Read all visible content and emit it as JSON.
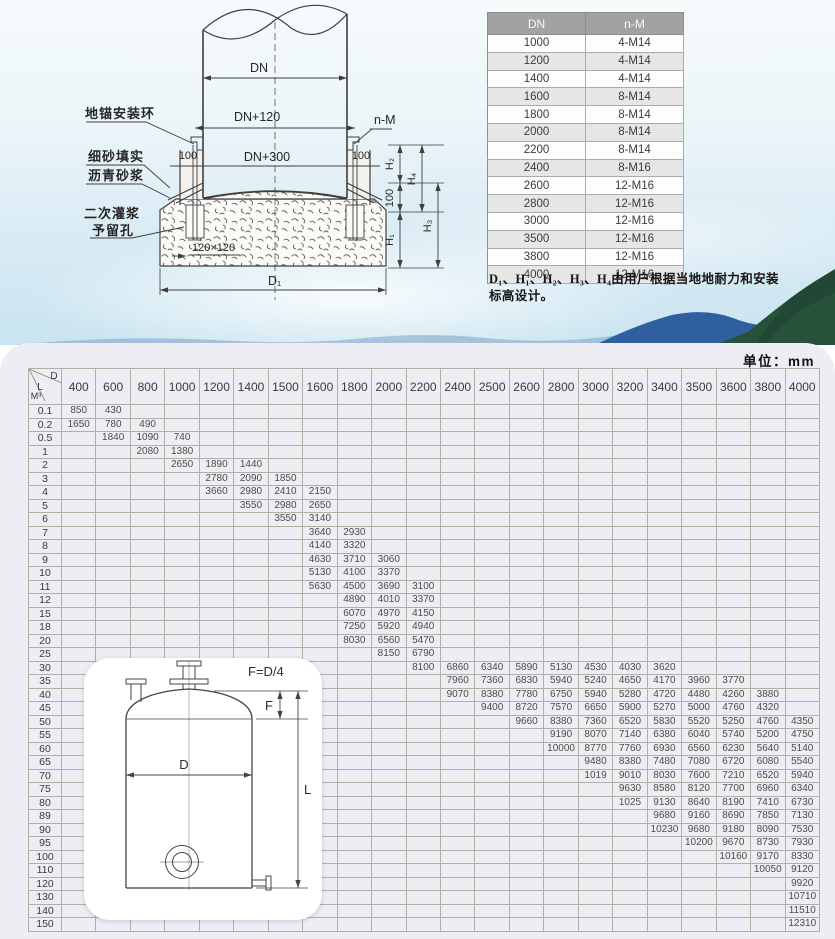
{
  "diagram": {
    "labels": {
      "anchor_ring": "地锚安装环",
      "fine_sand": "细砂填实",
      "asphalt_mortar": "沥青砂浆",
      "secondary_grout": "二次灌浆",
      "reserved_hole": "予留孔",
      "dn": "DN",
      "dn_plus_120": "DN+120",
      "dn_plus_300": "DN+300",
      "n_m": "n-M",
      "dim_100_left": "100",
      "dim_100_right": "100",
      "dim_100_vert": "100",
      "pocket": "120×120",
      "d1": "D₁",
      "h1": "H₁",
      "h2": "H₂",
      "h3": "H₃",
      "h4": "H₄"
    }
  },
  "dn_table": {
    "headers": [
      "DN",
      "n-M"
    ],
    "rows": [
      [
        "1000",
        "4-M14"
      ],
      [
        "1200",
        "4-M14"
      ],
      [
        "1400",
        "4-M14"
      ],
      [
        "1600",
        "8-M14"
      ],
      [
        "1800",
        "8-M14"
      ],
      [
        "2000",
        "8-M14"
      ],
      [
        "2200",
        "8-M14"
      ],
      [
        "2400",
        "8-M16"
      ],
      [
        "2600",
        "12-M16"
      ],
      [
        "2800",
        "12-M16"
      ],
      [
        "3000",
        "12-M16"
      ],
      [
        "3500",
        "12-M16"
      ],
      [
        "3800",
        "12-M16"
      ],
      [
        "4000",
        "12-M16"
      ]
    ]
  },
  "note": "D₁、H₁、H₂、H₃、H₄由用户根据当地地耐力和安装标高设计。",
  "capacity_table": {
    "unit_label": "单位：mm",
    "corner": {
      "d": "D",
      "l": "L",
      "m3": "M³"
    },
    "columns": [
      "400",
      "600",
      "800",
      "1000",
      "1200",
      "1400",
      "1500",
      "1600",
      "1800",
      "2000",
      "2200",
      "2400",
      "2500",
      "2600",
      "2800",
      "3000",
      "3200",
      "3400",
      "3500",
      "3600",
      "3800",
      "4000"
    ],
    "rows": [
      {
        "label": "0.1",
        "offset": 0,
        "values": [
          "850",
          "430"
        ]
      },
      {
        "label": "0.2",
        "offset": 0,
        "values": [
          "1650",
          "780",
          "490"
        ]
      },
      {
        "label": "0.5",
        "offset": 1,
        "values": [
          "1840",
          "1090",
          "740"
        ]
      },
      {
        "label": "1",
        "offset": 2,
        "values": [
          "2080",
          "1380"
        ]
      },
      {
        "label": "2",
        "offset": 3,
        "values": [
          "2650",
          "1890",
          "1440"
        ]
      },
      {
        "label": "3",
        "offset": 4,
        "values": [
          "2780",
          "2090",
          "1850"
        ]
      },
      {
        "label": "4",
        "offset": 4,
        "values": [
          "3660",
          "2980",
          "2410",
          "2150"
        ]
      },
      {
        "label": "5",
        "offset": 5,
        "values": [
          "3550",
          "2980",
          "2650"
        ]
      },
      {
        "label": "6",
        "offset": 6,
        "values": [
          "3550",
          "3140"
        ]
      },
      {
        "label": "7",
        "offset": 7,
        "values": [
          "3640",
          "2930"
        ]
      },
      {
        "label": "8",
        "offset": 7,
        "values": [
          "4140",
          "3320"
        ]
      },
      {
        "label": "9",
        "offset": 7,
        "values": [
          "4630",
          "3710",
          "3060"
        ]
      },
      {
        "label": "10",
        "offset": 7,
        "values": [
          "5130",
          "4100",
          "3370"
        ]
      },
      {
        "label": "11",
        "offset": 7,
        "values": [
          "5630",
          "4500",
          "3690",
          "3100"
        ]
      },
      {
        "label": "12",
        "offset": 8,
        "values": [
          "4890",
          "4010",
          "3370"
        ]
      },
      {
        "label": "15",
        "offset": 8,
        "values": [
          "6070",
          "4970",
          "4150"
        ]
      },
      {
        "label": "18",
        "offset": 8,
        "values": [
          "7250",
          "5920",
          "4940"
        ]
      },
      {
        "label": "20",
        "offset": 8,
        "values": [
          "8030",
          "6560",
          "5470"
        ]
      },
      {
        "label": "25",
        "offset": 9,
        "values": [
          "8150",
          "6790"
        ]
      },
      {
        "label": "30",
        "offset": 10,
        "values": [
          "8100",
          "6860",
          "6340",
          "5890",
          "5130",
          "4530",
          "4030",
          "3620"
        ]
      },
      {
        "label": "35",
        "offset": 11,
        "values": [
          "7960",
          "7360",
          "6830",
          "5940",
          "5240",
          "4650",
          "4170",
          "3960",
          "3770"
        ]
      },
      {
        "label": "40",
        "offset": 11,
        "values": [
          "9070",
          "8380",
          "7780",
          "6750",
          "5940",
          "5280",
          "4720",
          "4480",
          "4260",
          "3880"
        ]
      },
      {
        "label": "45",
        "offset": 12,
        "values": [
          "9400",
          "8720",
          "7570",
          "6650",
          "5900",
          "5270",
          "5000",
          "4760",
          "4320"
        ]
      },
      {
        "label": "50",
        "offset": 13,
        "values": [
          "9660",
          "8380",
          "7360",
          "6520",
          "5830",
          "5520",
          "5250",
          "4760",
          "4350"
        ]
      },
      {
        "label": "55",
        "offset": 14,
        "values": [
          "9190",
          "8070",
          "7140",
          "6380",
          "6040",
          "5740",
          "5200",
          "4750"
        ]
      },
      {
        "label": "60",
        "offset": 14,
        "values": [
          "10000",
          "8770",
          "7760",
          "6930",
          "6560",
          "6230",
          "5640",
          "5140"
        ]
      },
      {
        "label": "65",
        "offset": 15,
        "values": [
          "9480",
          "8380",
          "7480",
          "7080",
          "6720",
          "6080",
          "5540"
        ]
      },
      {
        "label": "70",
        "offset": 15,
        "values": [
          "1019",
          "9010",
          "8030",
          "7600",
          "7210",
          "6520",
          "5940"
        ]
      },
      {
        "label": "75",
        "offset": 16,
        "values": [
          "9630",
          "8580",
          "8120",
          "7700",
          "6960",
          "6340"
        ]
      },
      {
        "label": "80",
        "offset": 16,
        "values": [
          "1025",
          "9130",
          "8640",
          "8190",
          "7410",
          "6730"
        ]
      },
      {
        "label": "89",
        "offset": 17,
        "values": [
          "9680",
          "9160",
          "8690",
          "7850",
          "7130"
        ]
      },
      {
        "label": "90",
        "offset": 17,
        "values": [
          "10230",
          "9680",
          "9180",
          "8090",
          "7530"
        ]
      },
      {
        "label": "95",
        "offset": 18,
        "values": [
          "10200",
          "9670",
          "8730",
          "7930"
        ]
      },
      {
        "label": "100",
        "offset": 19,
        "values": [
          "10160",
          "9170",
          "8330"
        ]
      },
      {
        "label": "110",
        "offset": 20,
        "values": [
          "10050",
          "9120"
        ]
      },
      {
        "label": "120",
        "offset": 21,
        "values": [
          "9920"
        ]
      },
      {
        "label": "130",
        "offset": 21,
        "values": [
          "10710"
        ]
      },
      {
        "label": "140",
        "offset": 21,
        "values": [
          "11510"
        ]
      },
      {
        "label": "150",
        "offset": 21,
        "values": [
          "12310"
        ]
      }
    ]
  },
  "tank_inset": {
    "formula": "F=D/4",
    "f_label": "F",
    "d_label": "D",
    "l_label": "L"
  }
}
